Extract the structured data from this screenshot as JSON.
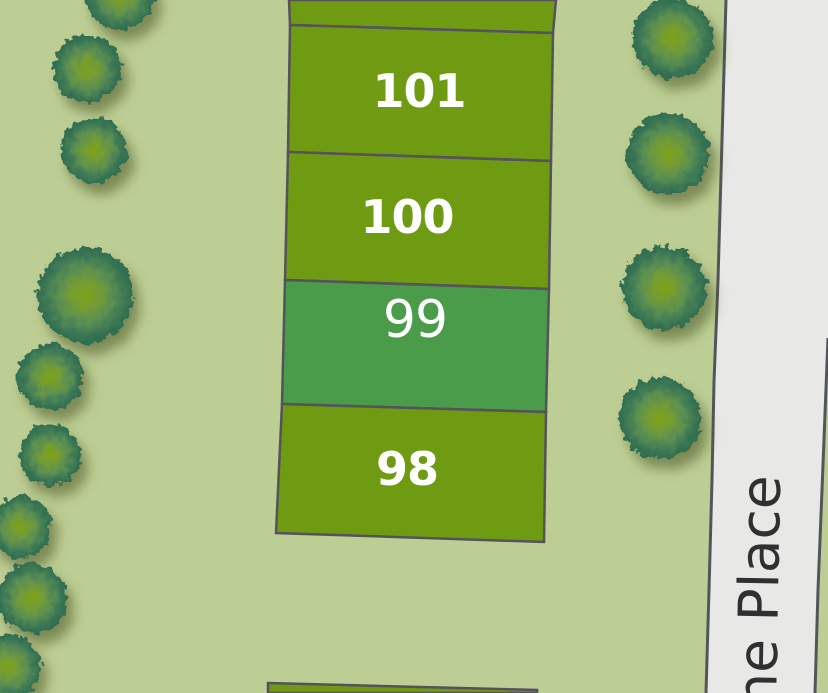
{
  "map": {
    "description": "plot map with numbered parcels, street and trees",
    "plots": [
      {
        "label": "101",
        "state": "available"
      },
      {
        "label": "100",
        "state": "available"
      },
      {
        "label": "99",
        "state": "selected"
      },
      {
        "label": "98",
        "state": "available"
      }
    ],
    "street": {
      "label": "ne Place"
    },
    "colors": {
      "lawn": "#bdce95",
      "plot_available": "#6f9b13",
      "plot_selected": "#4a9b4a",
      "plot_border": "#55525c",
      "road_fill": "#e8e8e6",
      "road_border": "#54545c",
      "plot_label_text": "#ffffff",
      "street_text": "#303030",
      "tree_center": "#7ea315",
      "tree_edge": "#2e6b50"
    }
  }
}
